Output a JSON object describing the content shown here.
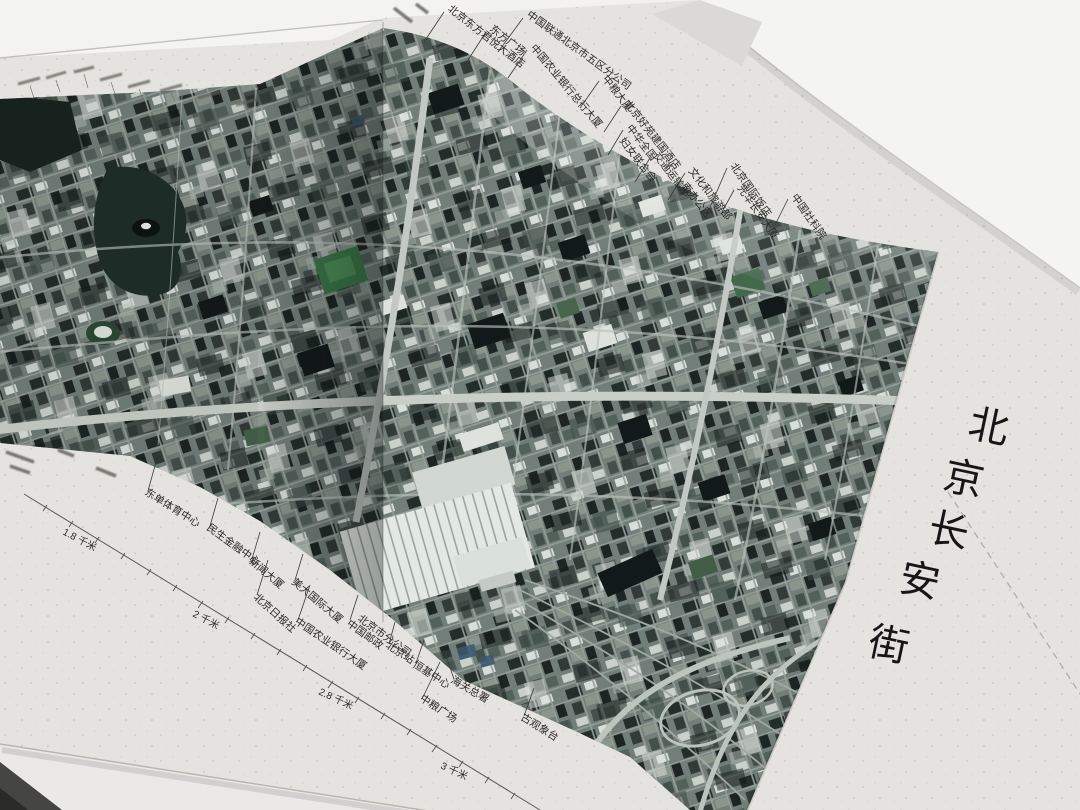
{
  "photo_subject": "folded satellite-map book of Beijing Chang'an Street",
  "cover": {
    "title_full": "北京长安街",
    "title_chars": [
      "北",
      "京",
      "长",
      "安",
      "街"
    ]
  },
  "map_panel": {
    "top_labels": [
      {
        "text": "北京东方君悦大酒店"
      },
      {
        "text": "东方广场"
      },
      {
        "text": "中国联通北京市五区分公司"
      },
      {
        "text": "中国农业银行总行大厦"
      },
      {
        "text": "中粮大厦"
      },
      {
        "text": "北京好苑建国酒店"
      },
      {
        "text": "中华全国",
        "text2": "妇女联合会"
      },
      {
        "text": "交通运输部"
      },
      {
        "text": "文化和旅游部",
        "text2": "南办公区"
      },
      {
        "text": "北京国际饭店"
      },
      {
        "text": "光华长安大厦"
      },
      {
        "text": "中国社科院"
      }
    ],
    "bottom_labels": [
      {
        "text": "东单体育中心"
      },
      {
        "text": "民生金融中心"
      },
      {
        "text": "新闻大厦"
      },
      {
        "text": "北京日报社"
      },
      {
        "text": "美大国际大厦"
      },
      {
        "text": "中国农业银行大厦"
      },
      {
        "text": "中国邮政",
        "text2": "北京市分公司"
      },
      {
        "text": "北京站"
      },
      {
        "text": "恒基中心"
      },
      {
        "text": "海关总署"
      },
      {
        "text": "中粮广场"
      },
      {
        "text": "古观象台"
      }
    ],
    "scale_marks": [
      {
        "text": "1.8 千米"
      },
      {
        "text": "2 千米"
      },
      {
        "text": "2.8 千米"
      },
      {
        "text": "3 千米"
      }
    ]
  },
  "colors": {
    "paper": "#e9e8e4",
    "background": "#f7f7f5",
    "imagery_base": "#74817c",
    "imagery_dark": "#1d2624",
    "road": "#c6ccc7",
    "label_ink": "#2a2a28",
    "title_ink": "#17171a"
  }
}
